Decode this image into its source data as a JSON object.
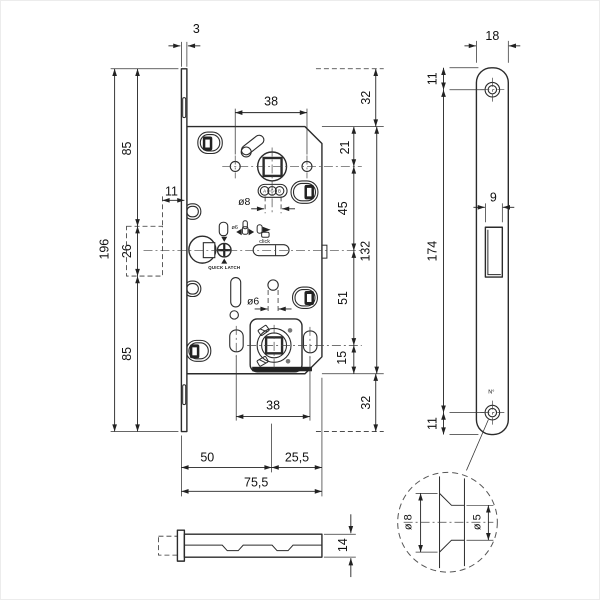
{
  "colors": {
    "line": "#2b2b2b",
    "background": "#ffffff"
  },
  "drawing": {
    "main_view": {
      "dims": {
        "faceplate_thickness": "3",
        "hub_span_top": "38",
        "offset_top": "32",
        "left_85_top": "85",
        "left_11": "11",
        "left_26": "26",
        "faceplate_height": "196",
        "left_85_bottom": "85",
        "right_21": "21",
        "right_45": "45",
        "body_height": "132",
        "right_51": "51",
        "right_15": "15",
        "offset_bottom": "32",
        "hub_span_bottom": "38",
        "backset": "50",
        "back_width": "25,5",
        "total_depth": "75,5",
        "spindle_dia": "ø8",
        "wc_hole_dia": "ø6"
      },
      "labels": {
        "latch_icon_dia": "ø6",
        "click": "click",
        "quick_latch": "QUICK LATCH",
        "logo": [
          "A",
          "G",
          "B"
        ]
      }
    },
    "side_view": {
      "dims": {
        "body_thickness": "14"
      }
    },
    "strike_plate": {
      "dims": {
        "width": "18",
        "top_hole_offset": "11",
        "hole_width": "9",
        "holes_span": "174",
        "bottom_hole_offset": "11"
      },
      "labels": {
        "number": "N°"
      }
    },
    "detail_view": {
      "dims": {
        "countersink_dia": "ø 8",
        "hole_dia": "ø 5"
      }
    }
  }
}
